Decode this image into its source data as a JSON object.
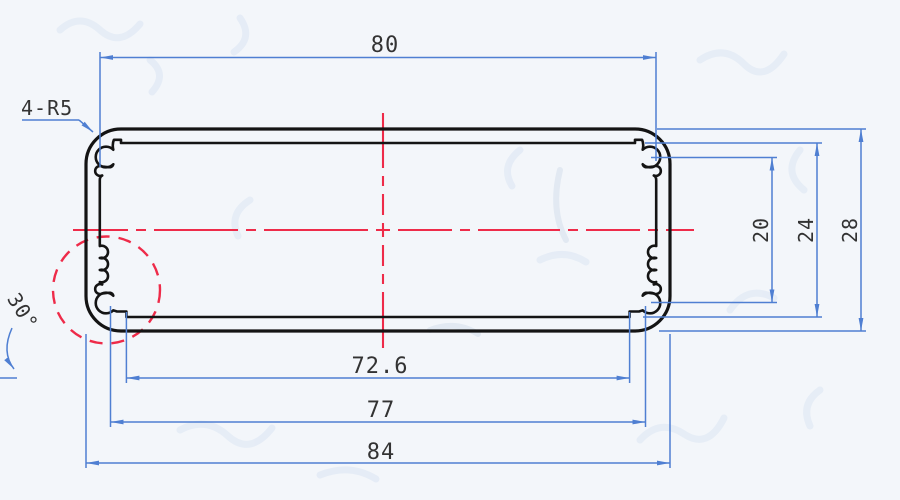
{
  "drawing": {
    "labels": {
      "top_width": "80",
      "corner_radius_note": "4-R5",
      "boss_span_height": "20",
      "inner_height": "24",
      "outer_height": "28",
      "inner_bottom_width": "72.6",
      "boss_span_width": "77",
      "outer_width": "84",
      "serration_angle": "30°"
    },
    "colors": {
      "outline": "#141414",
      "dimension_blue": "#4f7fd2",
      "centerline_red": "#ee2b49",
      "background": "#f3f6fa",
      "label_text": "#333333"
    }
  }
}
